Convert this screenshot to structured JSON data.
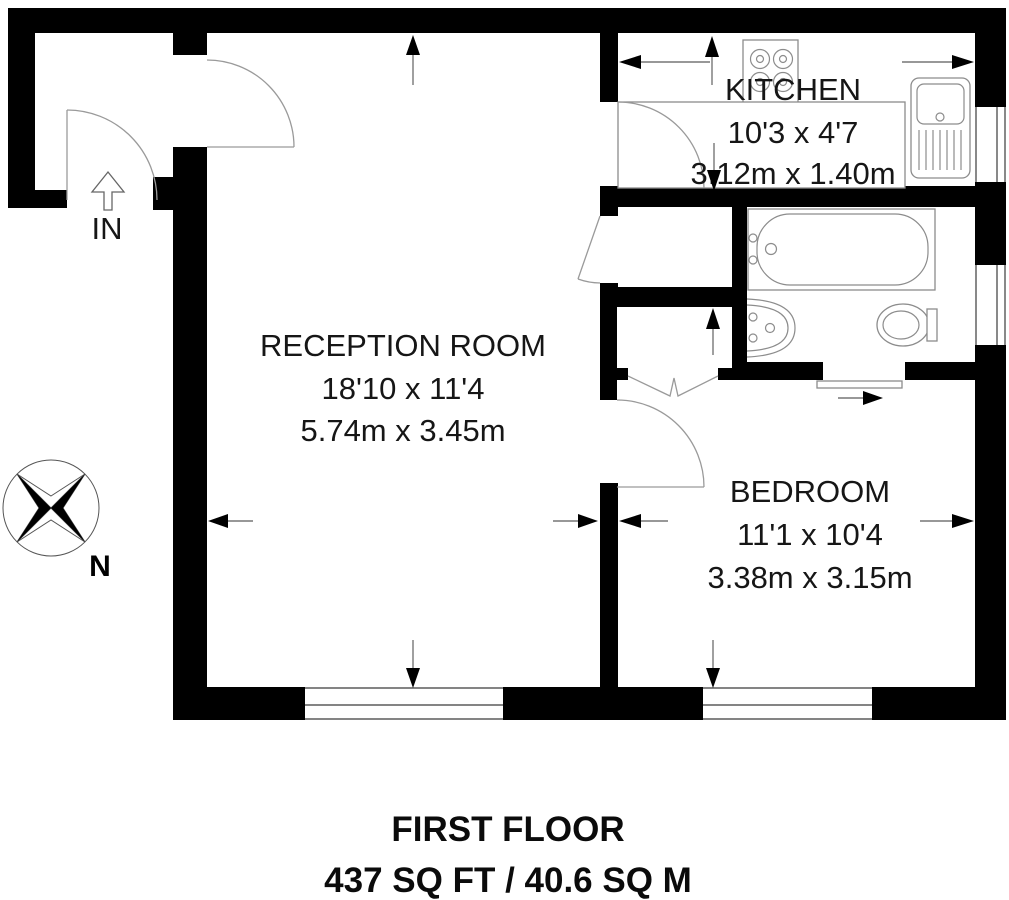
{
  "floor_plan": {
    "rooms": [
      {
        "name": "RECEPTION ROOM",
        "size_imperial": "18'10 x 11'4",
        "size_metric": "5.74m x 3.45m"
      },
      {
        "name": "KITCHEN",
        "size_imperial": "10'3 x 4'7",
        "size_metric": "3.12m x 1.40m"
      },
      {
        "name": "BEDROOM",
        "size_imperial": "11'1 x 10'4",
        "size_metric": "3.38m x 3.15m"
      }
    ],
    "entrance_label": "IN",
    "compass_north_label": "N",
    "footer": {
      "floor": "FIRST FLOOR",
      "area": "437 SQ FT / 40.6 SQ M"
    },
    "fixtures": [
      "hob",
      "kitchen-sink",
      "bathtub",
      "bathroom-sink",
      "toilet"
    ],
    "colors": {
      "walls": "#000000",
      "background": "#ffffff",
      "fixtures": "#8c8c8c",
      "text": "#161616"
    }
  }
}
